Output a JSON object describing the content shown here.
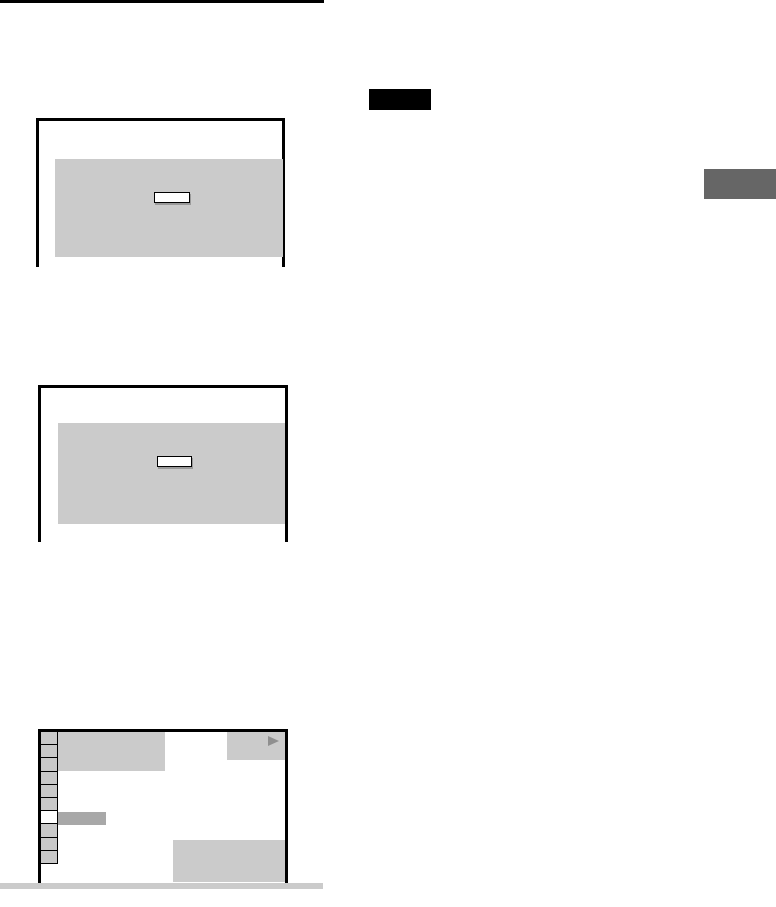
{
  "colors": {
    "ink": "#000000",
    "screen_fill": "#cbcbcb",
    "panel_fill": "#cbcbcb",
    "cell_fill": "#c9c9c9",
    "cell_highlight_fill": "#ffffff",
    "selected_row_fill": "#a8a8a8",
    "edge_tab_fill": "#666666",
    "bottom_bar_fill": "#cbcbcb",
    "button_face": "#ffffff",
    "button_shadow": "#9a9a9a",
    "play_icon_fill": "#8f8f8f",
    "note_badge_fill": "#000000"
  },
  "figures": {
    "menu_screen": {
      "sidebar_cells": [
        "normal",
        "normal",
        "normal",
        "normal",
        "normal",
        "normal",
        "highlighted",
        "normal",
        "normal",
        "normal"
      ],
      "play_icon": "play-triangle-icon"
    }
  }
}
